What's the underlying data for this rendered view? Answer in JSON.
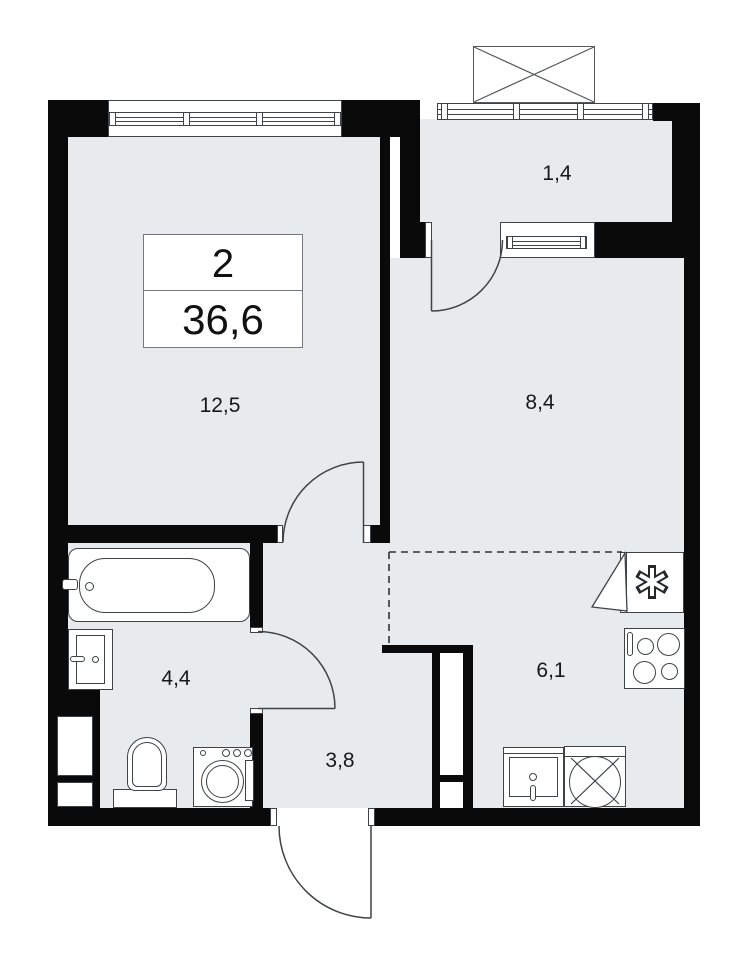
{
  "title_block": {
    "rooms_count": "2",
    "total_area": "36,6"
  },
  "rooms": {
    "living": {
      "area": "12,5"
    },
    "room": {
      "area": "8,4"
    },
    "balcony": {
      "area": "1,4"
    },
    "bathroom": {
      "area": "4,4"
    },
    "kitchen": {
      "area": "6,1"
    },
    "hallway": {
      "area": "3,8"
    }
  },
  "colors": {
    "wall": "#0a0a0a",
    "room_fill": "#e8ebed",
    "line": "#3e4347"
  }
}
